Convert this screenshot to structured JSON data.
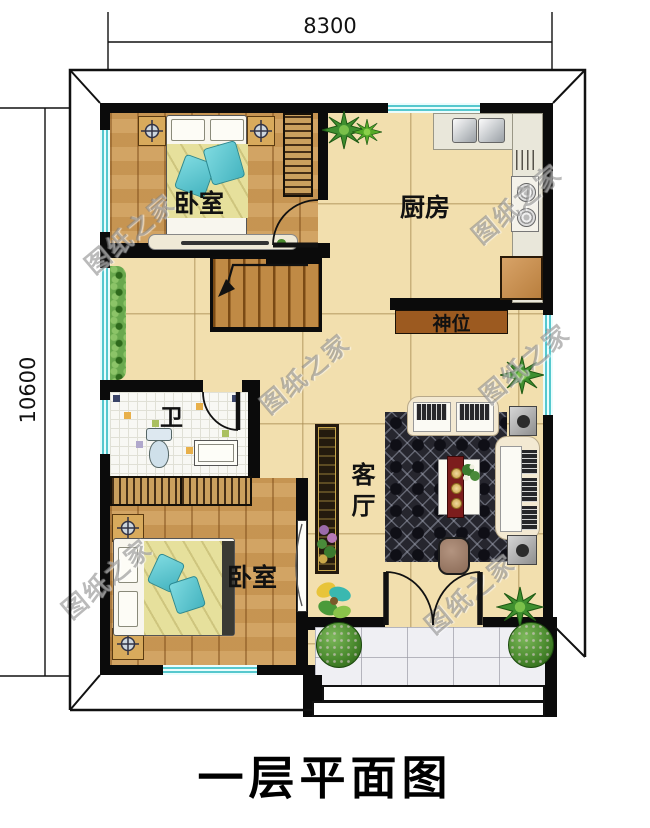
{
  "title": "一层平面图",
  "dimensions": {
    "width": "8300",
    "height": "10600"
  },
  "rooms": {
    "bedroom_top": {
      "label": "卧室"
    },
    "kitchen": {
      "label": "厨房"
    },
    "shrine": {
      "label": "神位"
    },
    "bathroom": {
      "label": "卫"
    },
    "living": {
      "label": "客厅"
    },
    "bedroom_bottom": {
      "label": "卧室"
    }
  },
  "watermark": {
    "text": "图纸之家"
  },
  "legend_colors": {
    "wall": "#0b0b0b",
    "wood_floor": "#cf9d58",
    "tile_floor": "#f2dfae",
    "window_glass": "#56c8ce",
    "shrine_cabinet": "#9c5a20",
    "rug": "#26262e",
    "sofa": "#f3e9d2",
    "pillow_accent": "#5bc8d2",
    "plant": "#3f8f2f"
  }
}
